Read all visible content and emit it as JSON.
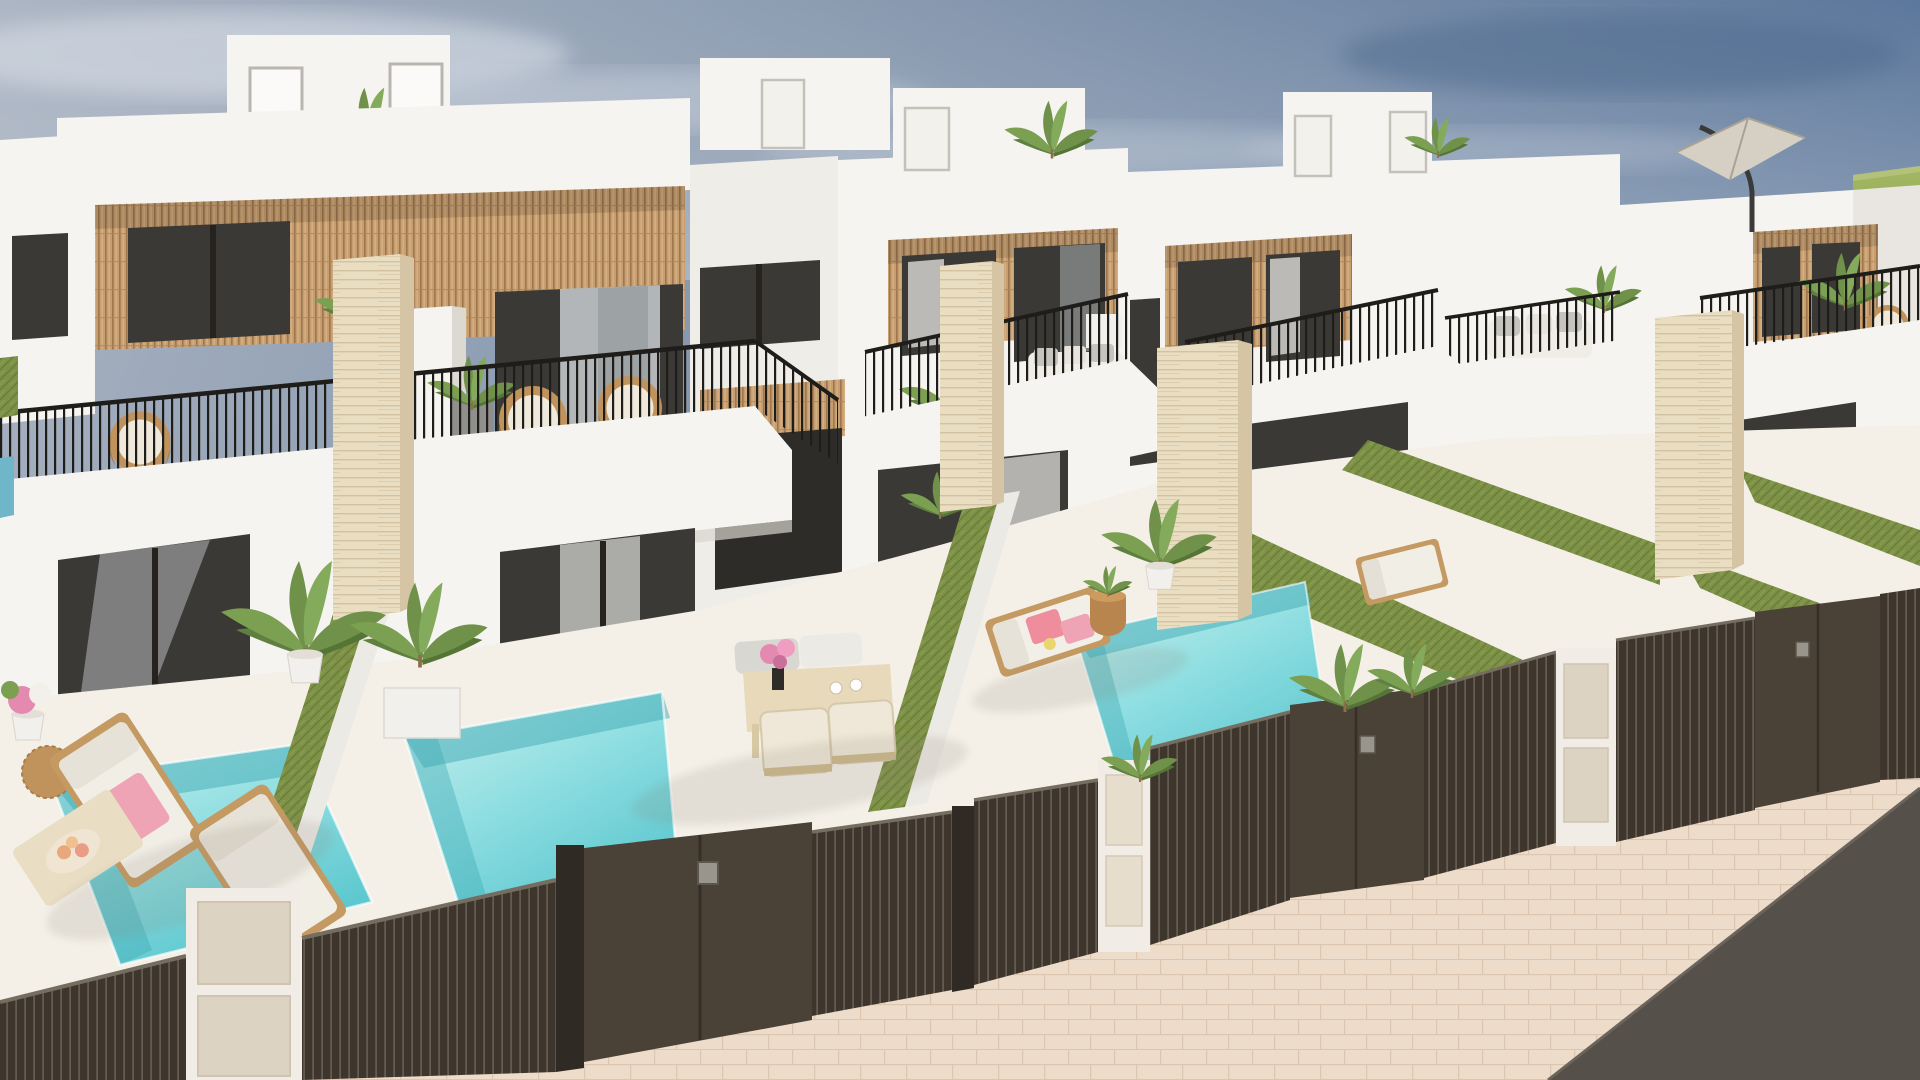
{
  "image": {
    "kind": "3d-architectural-render",
    "subject": "Row of modern white two-storey villas with wood-slat balconies, private pools, artificial-grass gardens and dark slatted street fences under a blue-grey sky",
    "time_of_day": "day"
  },
  "palette": {
    "sky_left": "#a9b2c1",
    "sky_right": "#506e96",
    "sky_haze": "#c3cad4",
    "cloud": "#dde2ea",
    "field_green": "#92a855",
    "wall_white": "#f6f4f0",
    "wall_shade": "#eae7e2",
    "wall_dark": "#dedad3",
    "wood_slat": "#c79e70",
    "wood_slat_line": "#9e764e",
    "window_frame": "#26231f",
    "glass_dark": "#3b3936",
    "glass_light": "#c9cdcf",
    "curtain_white": "#e6e4e0",
    "railing_black": "#1f1d1a",
    "lawn_green": "#7e9247",
    "lawn_dark": "#6a7d3a",
    "pool_light": "#cdf0ee",
    "pool_mid": "#8edee1",
    "pool_deep": "#57c5cd",
    "pool_shadow": "#3fa9b4",
    "travertine": "#e9ddc2",
    "travertine_line": "#d2c2a2",
    "fence_dark": "#3e362d",
    "fence_gate": "#4a4137",
    "fence_post": "#2f2a24",
    "fence_highlight": "#6d665b",
    "deck_white": "#f4f0e8",
    "sidewalk": "#eddcc9",
    "sidewalk_line": "#dcc6af",
    "road_gray": "#56504a",
    "pillar_panel": "#ddd3c2",
    "towel_pink": "#eea4b4",
    "towel_coral": "#ef8d9d",
    "towel_yellow": "#e9d66f",
    "cushion_gray": "#c6c4bf",
    "furniture_cream": "#e8d9ba",
    "furniture_wood": "#c59a62",
    "rattan": "#c1935c",
    "plant_green": "#6f9149",
    "plant_dark": "#557537",
    "pot_white": "#f2f0ec",
    "parasol_canvas": "#d6d0c4"
  },
  "objects": {
    "villas_visible": 5,
    "private_pools": 3,
    "sun_loungers": 5,
    "dining_tables": 2,
    "dining_chairs": 2,
    "rattan_chairs": 3,
    "travertine_pillars": 4,
    "grass_divider_walls": 2,
    "roof_access_boxes": 4,
    "parasols": 1,
    "street_gates": 3,
    "white_gate_pillars": 3,
    "potted_plants": 12
  }
}
